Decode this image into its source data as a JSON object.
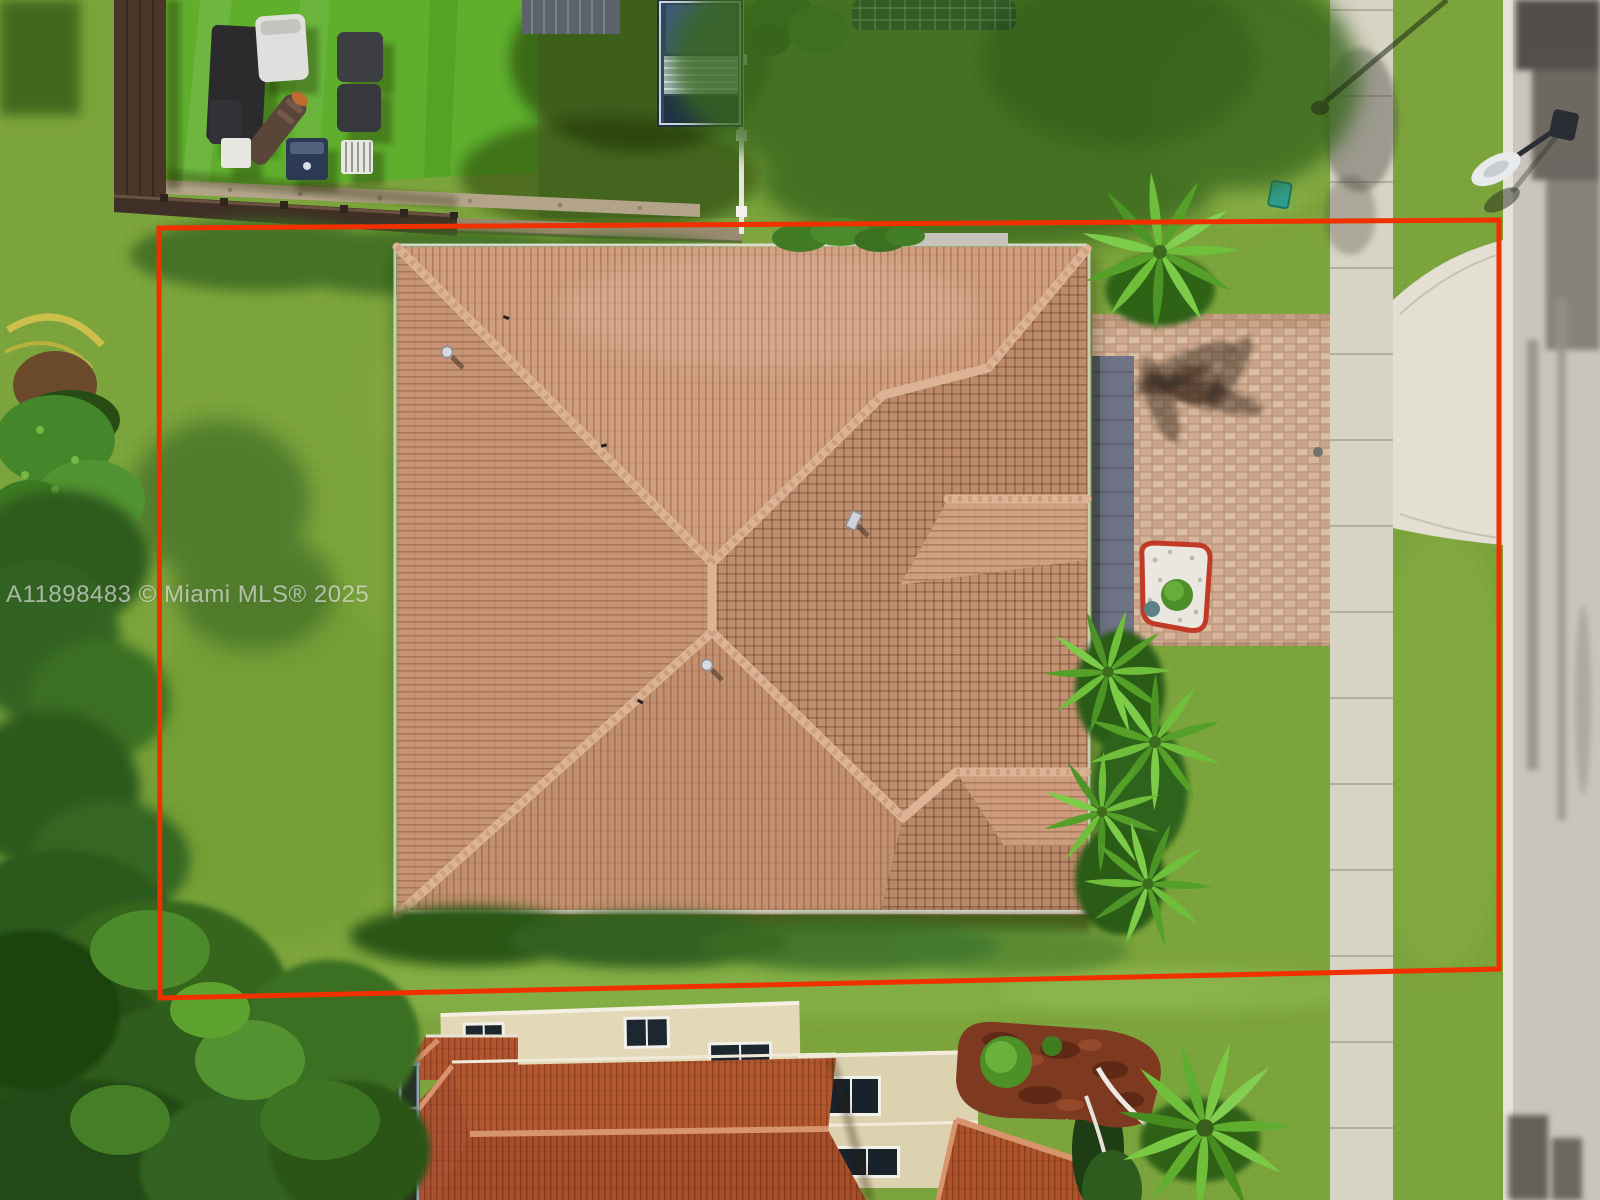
{
  "watermark": {
    "text": "A11898483 © Miami MLS® 2025"
  },
  "boundary": {
    "color": "#f13000"
  },
  "palette": {
    "lawn": "#7ca43c",
    "turf": "#5fae2c",
    "roof_tile": "#c69374",
    "roof_ridge": "#dcb395",
    "neighbor_roof": "#b4572e",
    "cream_wall": "#e3d8b8",
    "pavers": "#d6b298",
    "paver_border": "#6e7386",
    "sidewalk": "#d7d3c5",
    "street": "#c9c5bc",
    "concrete_apron": "#e3dfd3",
    "fence": "#4a3729"
  }
}
